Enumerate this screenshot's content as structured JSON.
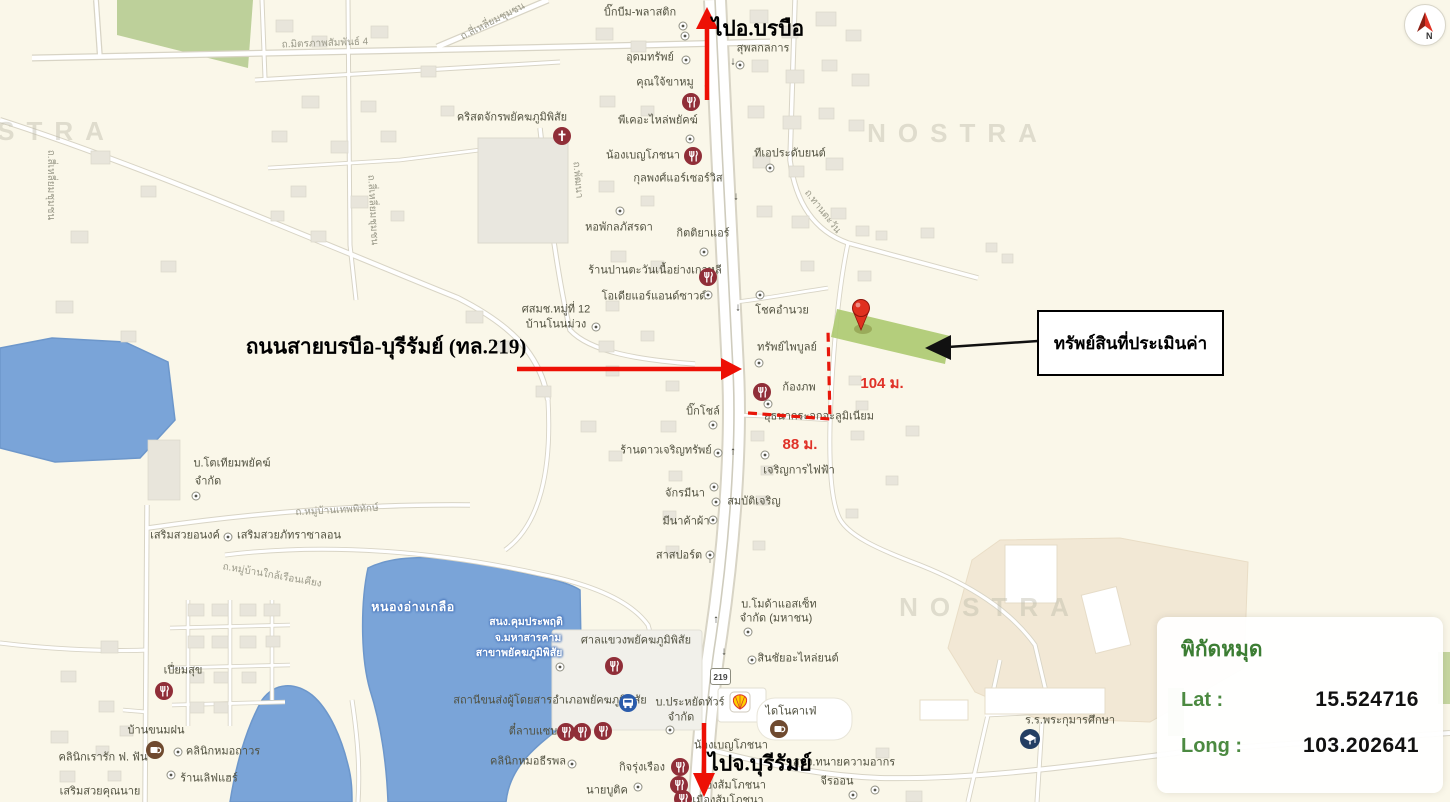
{
  "map": {
    "watermark": "NOSTRA",
    "compass_label": "N",
    "route_shield": "219",
    "annotations": {
      "to_north": "ไปอ.บรบือ",
      "to_south": "ไปจ.บุรีรัมย์",
      "highway_label": "ถนนสายบรบือ-บุรีรัมย์ (ทล.219)",
      "callout": "ทรัพย์สินที่ประเมินค่า",
      "dist_parcel": "104 ม.",
      "dist_road": "88 ม."
    },
    "coords": {
      "title": "พิกัดหมุด",
      "lat_label": "Lat :",
      "lat_value": "15.524716",
      "long_label": "Long :",
      "long_value": "103.202641"
    },
    "watermarks": [
      {
        "x": 25,
        "y": 131
      },
      {
        "x": 958,
        "y": 133
      },
      {
        "x": 990,
        "y": 607
      }
    ],
    "pois": [
      {
        "t": "บิ๊กบีม-พลาสติก",
        "x": 640,
        "y": 13
      },
      {
        "t": "อุดมทรัพย์",
        "x": 650,
        "y": 58
      },
      {
        "t": "สุพลกลการ",
        "x": 763,
        "y": 49
      },
      {
        "t": "คุณใจ้ขาหมู",
        "x": 665,
        "y": 83
      },
      {
        "t": "พีเคอะไหล่พยัคฆ์",
        "x": 658,
        "y": 121
      },
      {
        "t": "ทีเอประดับยนต์",
        "x": 790,
        "y": 154
      },
      {
        "t": "น้องเบญโภชนา",
        "x": 643,
        "y": 156
      },
      {
        "t": "กุลพงศ์แอร์เซอร์วิส",
        "x": 678,
        "y": 179
      },
      {
        "t": "คริสตจักรพยัคฆภูมิพิสัย",
        "x": 512,
        "y": 118
      },
      {
        "t": "หอพักลภัสรดา",
        "x": 619,
        "y": 228
      },
      {
        "t": "กิตติยาแอร์",
        "x": 703,
        "y": 234
      },
      {
        "t": "ร้านปานตะวันเนื้อย่างเกาหลี",
        "x": 655,
        "y": 271
      },
      {
        "t": "โอเดียแอร์แอนด์ซาวด์",
        "x": 654,
        "y": 297
      },
      {
        "t": "ศสมช.หมู่ที่ 12",
        "x": 556,
        "y": 310
      },
      {
        "t": "บ้านโนนม่วง",
        "x": 556,
        "y": 325
      },
      {
        "t": "โชคอำนวย",
        "x": 782,
        "y": 311
      },
      {
        "t": "ทรัพย์ไพบูลย์",
        "x": 787,
        "y": 348
      },
      {
        "t": "ก้องภพ",
        "x": 799,
        "y": 388
      },
      {
        "t": "ยุธนากระจกอะลูมิเนียม",
        "x": 819,
        "y": 417
      },
      {
        "t": "บิ๊กโชล์",
        "x": 703,
        "y": 412
      },
      {
        "t": "ร้านดาวเจริญทรัพย์",
        "x": 666,
        "y": 451
      },
      {
        "t": "เจริญการไฟฟ้า",
        "x": 799,
        "y": 471
      },
      {
        "t": "จักรมีนา",
        "x": 685,
        "y": 494
      },
      {
        "t": "สมบัติเจริญ",
        "x": 754,
        "y": 502
      },
      {
        "t": "มีนาค้าผ้า",
        "x": 686,
        "y": 522
      },
      {
        "t": "สาสปอร์ต",
        "x": 679,
        "y": 556
      },
      {
        "t": "บ.โมด้าแอสเซ็ท",
        "x": 779,
        "y": 605
      },
      {
        "t": "จำกัด (มหาชน)",
        "x": 776,
        "y": 619
      },
      {
        "t": "สินชัยอะไหล่ยนต์",
        "x": 798,
        "y": 659
      },
      {
        "t": "ศาลแขวงพยัคฆภูมิพิสัย",
        "x": 636,
        "y": 641
      },
      {
        "t": "สถานีขนส่งผู้โดยสารอำเภอพยัคฆภูมิพิสัย",
        "x": 550,
        "y": 701
      },
      {
        "t": "บ.ประหยัดทัวร์",
        "x": 690,
        "y": 703
      },
      {
        "t": "จำกัด",
        "x": 681,
        "y": 718
      },
      {
        "t": "ไดโนคาเฟ่",
        "x": 791,
        "y": 712
      },
      {
        "t": "น้องเบญโภชนา",
        "x": 731,
        "y": 746
      },
      {
        "t": "สนง.ทนายความอากร",
        "x": 844,
        "y": 763
      },
      {
        "t": "จีรออน",
        "x": 837,
        "y": 782
      },
      {
        "t": "น้องส้มโภชนา",
        "x": 732,
        "y": 786
      },
      {
        "t": "เมืองส้มโภชนา",
        "x": 728,
        "y": 801
      },
      {
        "t": "กิจรุ่งเรือง",
        "x": 642,
        "y": 768
      },
      {
        "t": "นายบูติค",
        "x": 607,
        "y": 791
      },
      {
        "t": "คลินิกหมอธีรพล",
        "x": 528,
        "y": 762
      },
      {
        "t": "ตี๋ลาบแซบ",
        "x": 533,
        "y": 732
      },
      {
        "t": "ร.ร.พระกุมารศึกษา",
        "x": 1070,
        "y": 721
      },
      {
        "t": "เปี่ยมสุข",
        "x": 183,
        "y": 671
      },
      {
        "t": "บ้านขนมฝน",
        "x": 156,
        "y": 731
      },
      {
        "t": "คลินิกเรารัก ฟ. ฟัน",
        "x": 103,
        "y": 758
      },
      {
        "t": "คลินิกหมอถาวร",
        "x": 223,
        "y": 752
      },
      {
        "t": "ร้านเลิฟแฮร์",
        "x": 209,
        "y": 779
      },
      {
        "t": "เสริมสวยคุณนาย",
        "x": 100,
        "y": 792
      },
      {
        "t": "เสริมสวยอนงค์",
        "x": 185,
        "y": 536
      },
      {
        "t": "เสริมสวยภัทราซาลอน",
        "x": 289,
        "y": 536
      },
      {
        "t": "บ.โตเทียมพยัคฆ์",
        "x": 232,
        "y": 464
      },
      {
        "t": "จำกัด",
        "x": 208,
        "y": 482
      }
    ],
    "road_labels": [
      {
        "t": "ถ.มิตรภาพสัมพันธ์ 4",
        "x": 325,
        "y": 44,
        "r": -2
      },
      {
        "t": "ถ.สี่เหลี่ยมชุมชน",
        "x": 493,
        "y": 22,
        "r": -27
      },
      {
        "t": "ถ.สี่เหลี่ยมชุมชน",
        "x": 50,
        "y": 185,
        "r": 90
      },
      {
        "t": "ถ.สี่เหลี่ยมชุมชน",
        "x": 372,
        "y": 210,
        "r": 87
      },
      {
        "t": "ถ.พัฒนา",
        "x": 577,
        "y": 180,
        "r": 85
      },
      {
        "t": "ถ.ทานตะวัน",
        "x": 822,
        "y": 212,
        "r": 52
      },
      {
        "t": "ถ.หมู่บ้านเทพพิทักษ์",
        "x": 337,
        "y": 511,
        "r": -3
      },
      {
        "t": "ถ.หมู่บ้านใกล้เรือนเคียง",
        "x": 272,
        "y": 576,
        "r": 10
      }
    ],
    "water_labels": [
      {
        "t": "หนองอ่างเกลือ",
        "x": 413,
        "y": 607
      },
      {
        "t": "สนง.คุมประพฤติ",
        "x": 526,
        "y": 622
      },
      {
        "t": "จ.มหาสารคาม",
        "x": 528,
        "y": 638
      },
      {
        "t": "สาขาพยัคฆภูมิพิสัย",
        "x": 519,
        "y": 653
      }
    ],
    "traffic_arrows": [
      {
        "t": "↑",
        "x": 706,
        "y": 88
      },
      {
        "t": "↓",
        "x": 733,
        "y": 62
      },
      {
        "t": "↓",
        "x": 736,
        "y": 197
      },
      {
        "t": "↓",
        "x": 738,
        "y": 308
      },
      {
        "t": "↑",
        "x": 733,
        "y": 452
      },
      {
        "t": "↑",
        "x": 710,
        "y": 560
      },
      {
        "t": "↑",
        "x": 716,
        "y": 620
      },
      {
        "t": "↓",
        "x": 724,
        "y": 652
      }
    ],
    "icons": [
      {
        "type": "restaurant",
        "x": 691,
        "y": 102
      },
      {
        "type": "restaurant",
        "x": 693,
        "y": 156
      },
      {
        "type": "restaurant",
        "x": 708,
        "y": 277
      },
      {
        "type": "restaurant",
        "x": 762,
        "y": 392
      },
      {
        "type": "restaurant",
        "x": 614,
        "y": 666
      },
      {
        "type": "restaurant",
        "x": 566,
        "y": 732
      },
      {
        "type": "restaurant",
        "x": 582,
        "y": 732
      },
      {
        "type": "restaurant",
        "x": 603,
        "y": 731
      },
      {
        "type": "restaurant",
        "x": 680,
        "y": 767
      },
      {
        "type": "restaurant",
        "x": 679,
        "y": 785
      },
      {
        "type": "restaurant",
        "x": 683,
        "y": 799
      },
      {
        "type": "restaurant",
        "x": 164,
        "y": 691
      },
      {
        "type": "church",
        "x": 562,
        "y": 136
      },
      {
        "type": "cafe",
        "x": 779,
        "y": 729
      },
      {
        "type": "cafe",
        "x": 155,
        "y": 750
      },
      {
        "type": "bus",
        "x": 628,
        "y": 703
      },
      {
        "type": "school",
        "x": 1030,
        "y": 739
      },
      {
        "type": "shell",
        "x": 740,
        "y": 702
      },
      {
        "type": "dot",
        "x": 683,
        "y": 26
      },
      {
        "type": "dot",
        "x": 685,
        "y": 36
      },
      {
        "type": "dot",
        "x": 686,
        "y": 60
      },
      {
        "type": "dot",
        "x": 740,
        "y": 65
      },
      {
        "type": "dot",
        "x": 690,
        "y": 139
      },
      {
        "type": "dot",
        "x": 770,
        "y": 168
      },
      {
        "type": "dot",
        "x": 620,
        "y": 211
      },
      {
        "type": "dot",
        "x": 704,
        "y": 252
      },
      {
        "type": "dot",
        "x": 708,
        "y": 295
      },
      {
        "type": "dot",
        "x": 760,
        "y": 295
      },
      {
        "type": "dot",
        "x": 596,
        "y": 327
      },
      {
        "type": "dot",
        "x": 759,
        "y": 363
      },
      {
        "type": "dot",
        "x": 768,
        "y": 404
      },
      {
        "type": "dot",
        "x": 713,
        "y": 425
      },
      {
        "type": "dot",
        "x": 718,
        "y": 453
      },
      {
        "type": "dot",
        "x": 765,
        "y": 455
      },
      {
        "type": "dot",
        "x": 714,
        "y": 487
      },
      {
        "type": "dot",
        "x": 716,
        "y": 502
      },
      {
        "type": "dot",
        "x": 713,
        "y": 520
      },
      {
        "type": "dot",
        "x": 710,
        "y": 555
      },
      {
        "type": "dot",
        "x": 748,
        "y": 632
      },
      {
        "type": "dot",
        "x": 752,
        "y": 660
      },
      {
        "type": "dot",
        "x": 670,
        "y": 730
      },
      {
        "type": "dot",
        "x": 196,
        "y": 496
      },
      {
        "type": "dot",
        "x": 228,
        "y": 537
      },
      {
        "type": "dot",
        "x": 560,
        "y": 667
      },
      {
        "type": "dot",
        "x": 572,
        "y": 764
      },
      {
        "type": "dot",
        "x": 638,
        "y": 787
      },
      {
        "type": "dot",
        "x": 171,
        "y": 775
      },
      {
        "type": "dot",
        "x": 178,
        "y": 752
      },
      {
        "type": "dot",
        "x": 853,
        "y": 795
      },
      {
        "type": "dot",
        "x": 875,
        "y": 790
      }
    ]
  }
}
